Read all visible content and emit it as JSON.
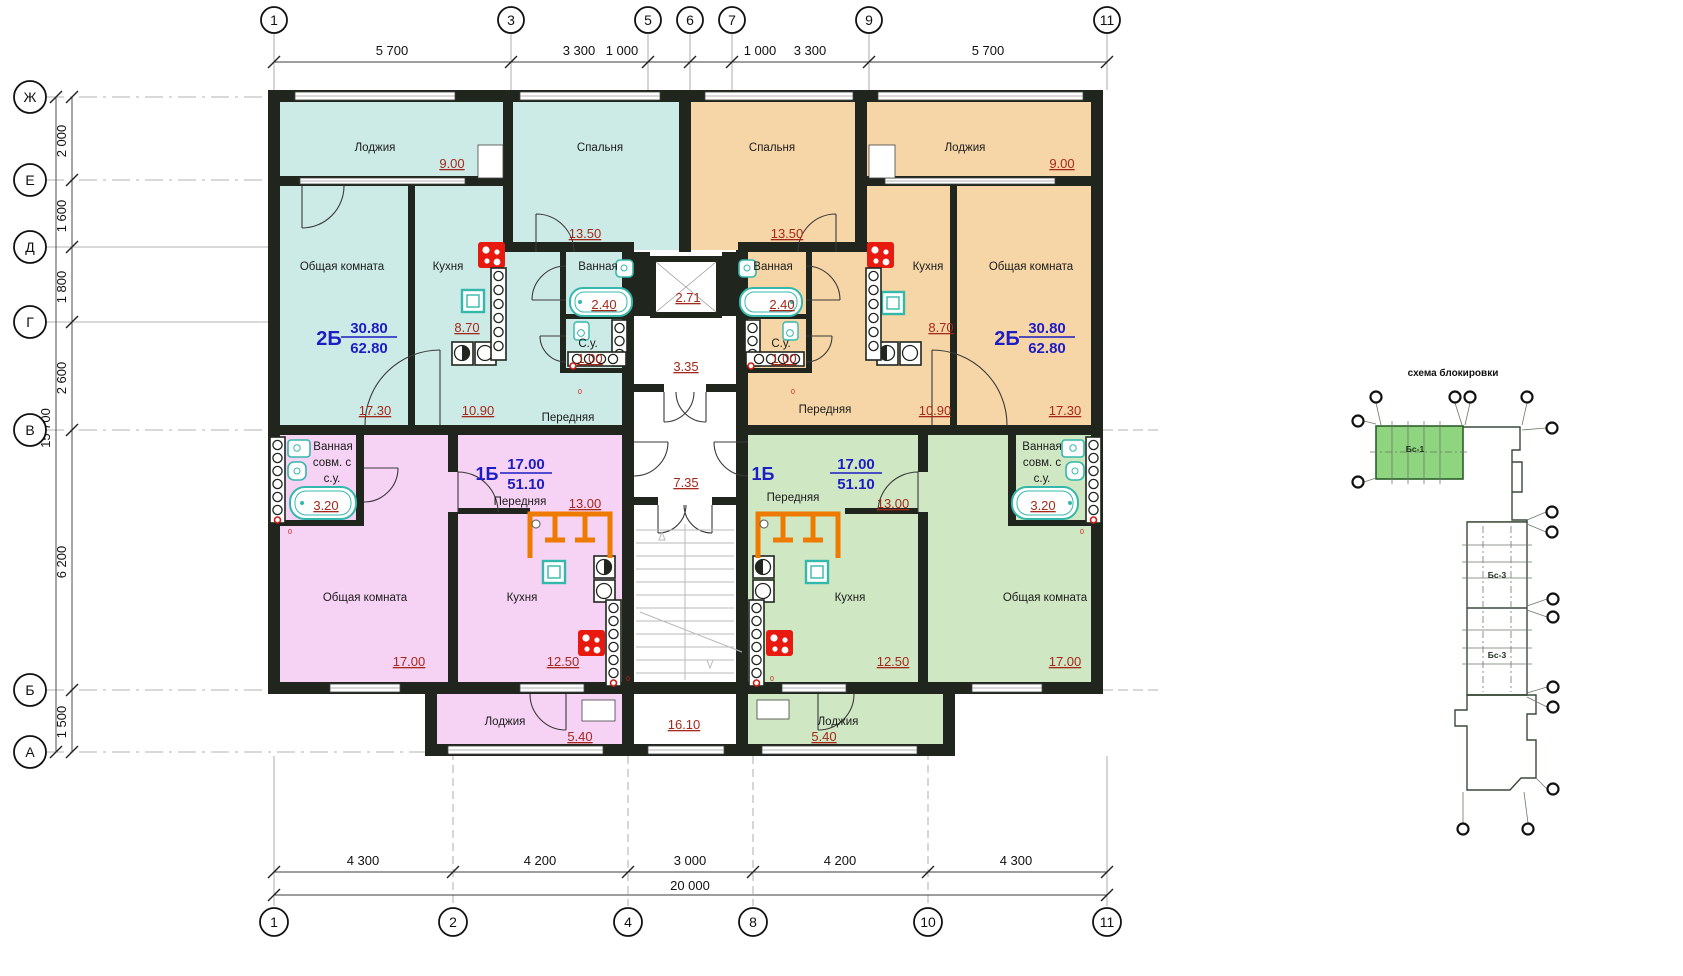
{
  "axes": {
    "top": [
      "1",
      "3",
      "5",
      "6",
      "7",
      "9",
      "11"
    ],
    "bottom": [
      "1",
      "2",
      "4",
      "8",
      "10",
      "11"
    ],
    "left": [
      "Ж",
      "Е",
      "Д",
      "Г",
      "В",
      "Б",
      "А"
    ]
  },
  "dims": {
    "top": [
      "5 700",
      "3 300",
      "1 000",
      "1 000",
      "3 300",
      "5 700"
    ],
    "bottom": [
      "4 300",
      "4 200",
      "3 000",
      "4 200",
      "4 300"
    ],
    "total_width": "20 000",
    "left": [
      "2 000",
      "1 600",
      "1 800",
      "2 600",
      "6 200",
      "1 500"
    ],
    "total_height": "15 700"
  },
  "flat_2b_left": {
    "type": "2Б",
    "living_area": "30.80",
    "total_area": "62.80",
    "loggia": "Лоджия",
    "loggia_area": "9.00",
    "bedroom": "Спальня",
    "bedroom_area": "13.50",
    "living_room": "Общая комната",
    "living_room_area": "17.30",
    "kitchen": "Кухня",
    "kitchen_area": "8.70",
    "bath": "Ванная",
    "bath_area": "2.40",
    "wc": "С.у.",
    "wc_area": "1.00",
    "hall": "Передняя",
    "hall_area": "10.90"
  },
  "flat_2b_right": {
    "type": "2Б",
    "living_area": "30.80",
    "total_area": "62.80",
    "loggia": "Лоджия",
    "loggia_area": "9.00",
    "bedroom": "Спальня",
    "bedroom_area": "13.50",
    "living_room": "Общая комната",
    "living_room_area": "17.30",
    "kitchen": "Кухня",
    "kitchen_area": "8.70",
    "bath": "Ванная",
    "bath_area": "2.40",
    "wc": "С.у.",
    "wc_area": "1.00",
    "hall": "Передняя",
    "hall_area": "10.90"
  },
  "flat_1b_left": {
    "type": "1Б",
    "living_area": "17.00",
    "total_area": "51.10",
    "bath_line1": "Ванная",
    "bath_line2": "совм. с",
    "bath_line3": "с.у.",
    "bath_area": "3.20",
    "hall": "Передняя",
    "hall_area": "13.00",
    "living_room": "Общая комната",
    "living_room_area": "17.00",
    "kitchen": "Кухня",
    "kitchen_area": "12.50",
    "loggia": "Лоджия",
    "loggia_area": "5.40"
  },
  "flat_1b_right": {
    "type": "1Б",
    "living_area": "17.00",
    "total_area": "51.10",
    "bath_line1": "Ванная",
    "bath_line2": "совм. с",
    "bath_line3": "с.у.",
    "bath_area": "3.20",
    "hall": "Передняя",
    "hall_area": "13.00",
    "living_room": "Общая комната",
    "living_room_area": "17.00",
    "kitchen": "Кухня",
    "kitchen_area": "12.50",
    "loggia": "Лоджия",
    "loggia_area": "5.40"
  },
  "core": {
    "elevator_area": "2.71",
    "lobby_area": "3.35",
    "hall_area": "7.35",
    "stair_area": "16.10"
  },
  "scheme": {
    "title": "схема блокировки",
    "block_1": "Бс-1",
    "block_3a": "Бс-3",
    "block_3b": "Бс-3"
  },
  "marks": {
    "zero": "0"
  },
  "colors": {
    "flat_2b_left": "#cdebe6",
    "flat_2b_right": "#f6d6a7",
    "flat_1b_left": "#f6d2f4",
    "flat_1b_right": "#cfe8c3",
    "wall": "#20261e",
    "area_text": "#a5281c",
    "type_text": "#1d1dc4",
    "stove": "#e8190f",
    "fixture": "#35b8ac",
    "wardrobe": "#ef7a00",
    "scheme_block": "#8fd57f"
  }
}
